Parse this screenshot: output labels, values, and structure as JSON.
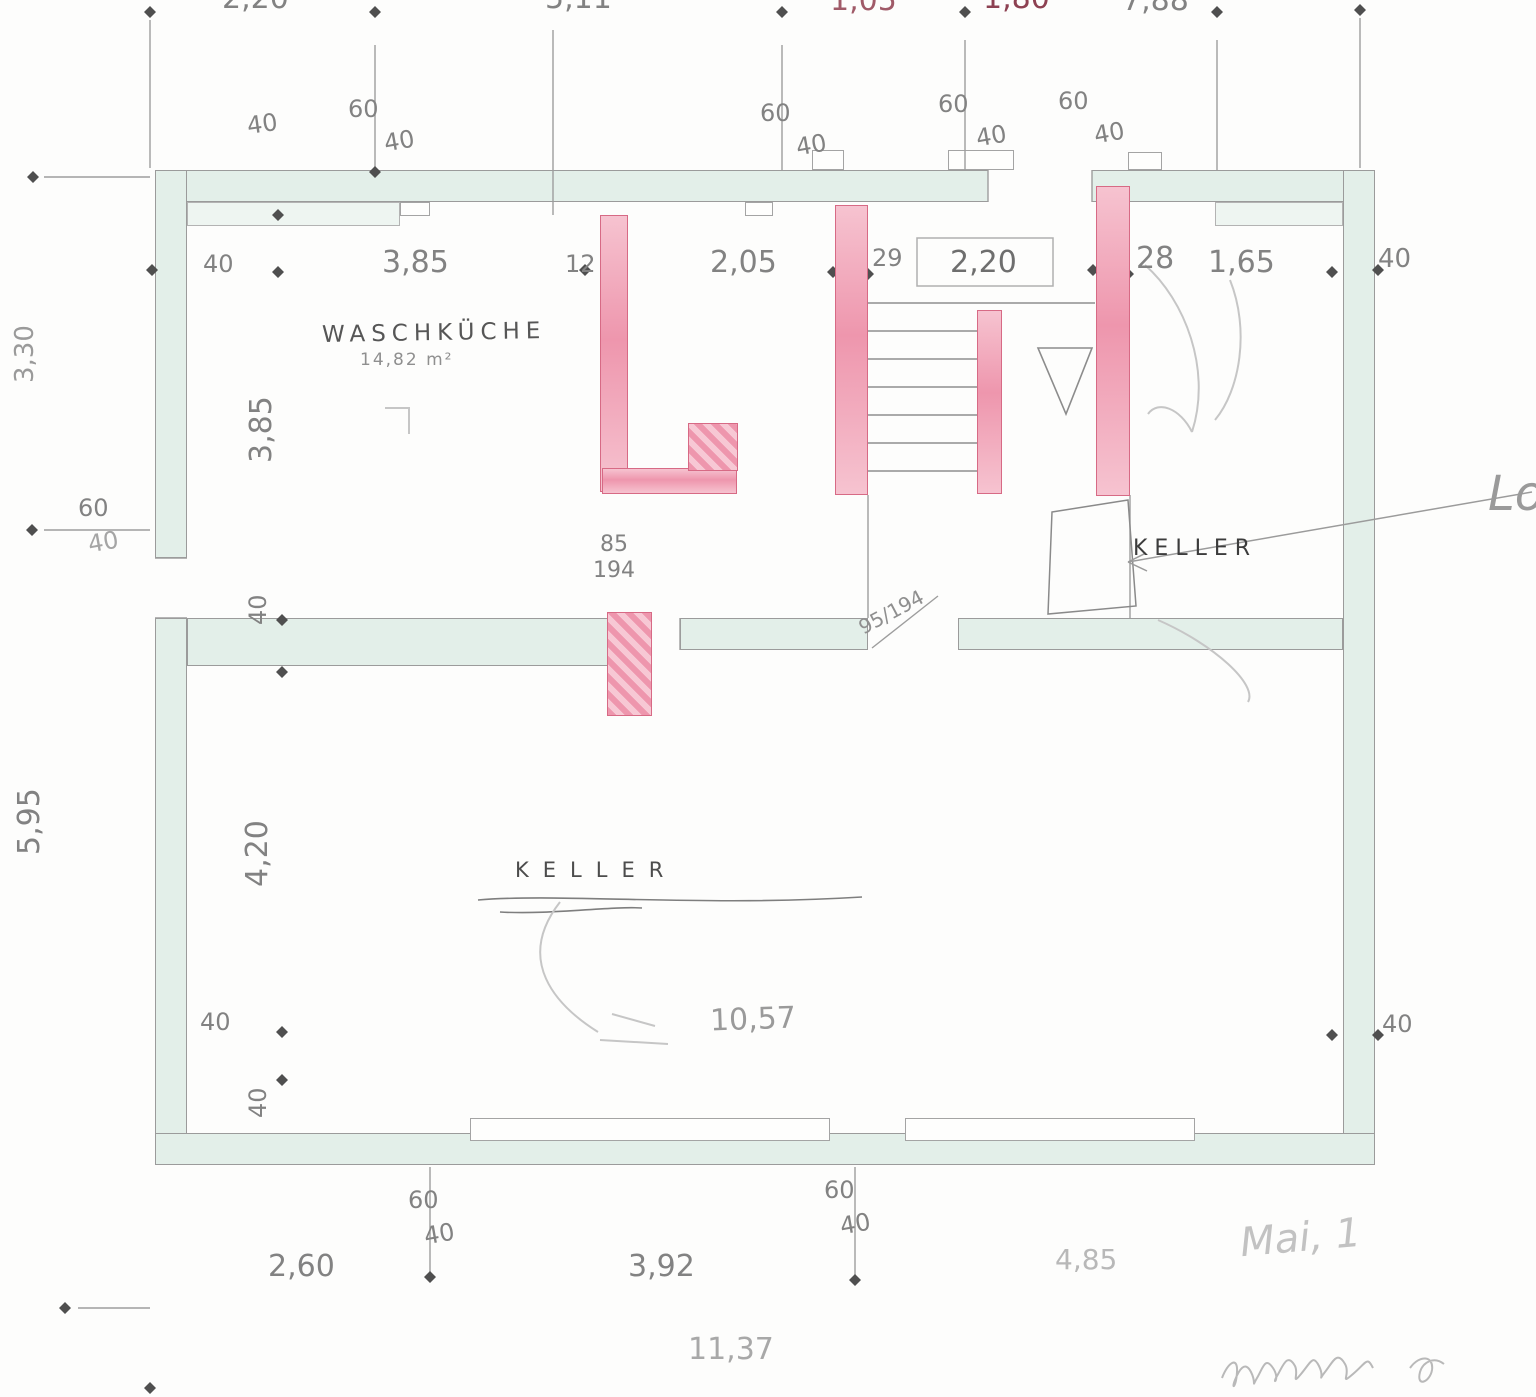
{
  "plan": {
    "rooms": {
      "waschkueche": {
        "label": "WASCHKÜCHE",
        "area": "14,82 m²"
      },
      "keller_small": {
        "label": "KELLER"
      },
      "keller_main": {
        "label": "KELLER"
      }
    },
    "dims": {
      "top_outer": [
        "2,20",
        "5,11",
        "1,05",
        "1,80",
        "7,88"
      ],
      "top_inner": [
        "40",
        "3,85",
        "12",
        "2,05",
        "29",
        "2,20",
        "28",
        "1,65",
        "40"
      ],
      "top_wall_single": "40",
      "left_outer": [
        "3,30",
        "5,95"
      ],
      "left_wall_pair": [
        "60",
        "40"
      ],
      "left_inner": [
        "3,85",
        "40",
        "4,20",
        "40",
        "40"
      ],
      "right_inner": [
        "40"
      ],
      "bottom_outer": [
        "2,60",
        "3,92",
        "4,85"
      ],
      "bottom_total": "11,37",
      "interior_width": "10,57",
      "door_left_w": "85",
      "door_left_h": "194",
      "door_mid": "95/194",
      "wall_pairs_top": [
        [
          "60",
          "40"
        ],
        [
          "60",
          "40"
        ],
        [
          "60",
          "40"
        ],
        [
          "60",
          "40"
        ]
      ],
      "wall_pairs_bottom": [
        [
          "60",
          "40"
        ],
        [
          "60",
          "40"
        ]
      ]
    },
    "handwriting": {
      "right_edge": "Lou",
      "note_bottom": "Mai, 1"
    }
  }
}
